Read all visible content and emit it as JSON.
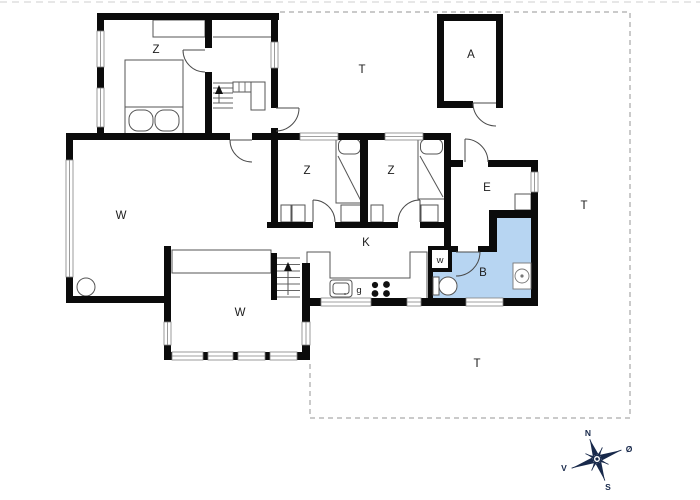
{
  "title": "holiday-home-floor-plan",
  "colors": {
    "wall": "#0b0b0b",
    "line": "#555555",
    "window_line": "#828282",
    "bath_fill": "#b7d5f2",
    "dashed": "#949494",
    "label": "#1c1c1c",
    "compass": "#18294b"
  },
  "rooms": [
    {
      "id": "bedroom-1",
      "label": "Z",
      "x": 156,
      "y": 53,
      "small": false
    },
    {
      "id": "terrace-north",
      "label": "T",
      "x": 362,
      "y": 73,
      "small": false
    },
    {
      "id": "annex",
      "label": "A",
      "x": 471,
      "y": 58,
      "small": false
    },
    {
      "id": "bedroom-2",
      "label": "Z",
      "x": 307,
      "y": 174,
      "small": false
    },
    {
      "id": "bedroom-3",
      "label": "Z",
      "x": 391,
      "y": 174,
      "small": false
    },
    {
      "id": "entrance-hall",
      "label": "E",
      "x": 487,
      "y": 191,
      "small": false
    },
    {
      "id": "terrace-east",
      "label": "T",
      "x": 584,
      "y": 209,
      "small": false
    },
    {
      "id": "living-room",
      "label": "W",
      "x": 121,
      "y": 219,
      "small": false
    },
    {
      "id": "kitchen",
      "label": "K",
      "x": 366,
      "y": 246,
      "small": false
    },
    {
      "id": "utility-cupboard",
      "label": "w",
      "x": 440,
      "y": 263,
      "small": true
    },
    {
      "id": "bathroom",
      "label": "B",
      "x": 483,
      "y": 276,
      "small": false
    },
    {
      "id": "cooker",
      "label": "g",
      "x": 359,
      "y": 293,
      "small": true
    },
    {
      "id": "living-room-2",
      "label": "W",
      "x": 240,
      "y": 316,
      "small": false
    },
    {
      "id": "terrace-south",
      "label": "T",
      "x": 477,
      "y": 367,
      "small": false
    }
  ],
  "compass": {
    "cx": 597,
    "cy": 459,
    "rotation": -20,
    "points": [
      {
        "id": "north",
        "label": "N",
        "x": 588,
        "y": 436
      },
      {
        "id": "east",
        "label": "Ø",
        "x": 629,
        "y": 452
      },
      {
        "id": "west",
        "label": "V",
        "x": 564,
        "y": 471
      },
      {
        "id": "south",
        "label": "S",
        "x": 608,
        "y": 490
      }
    ]
  }
}
